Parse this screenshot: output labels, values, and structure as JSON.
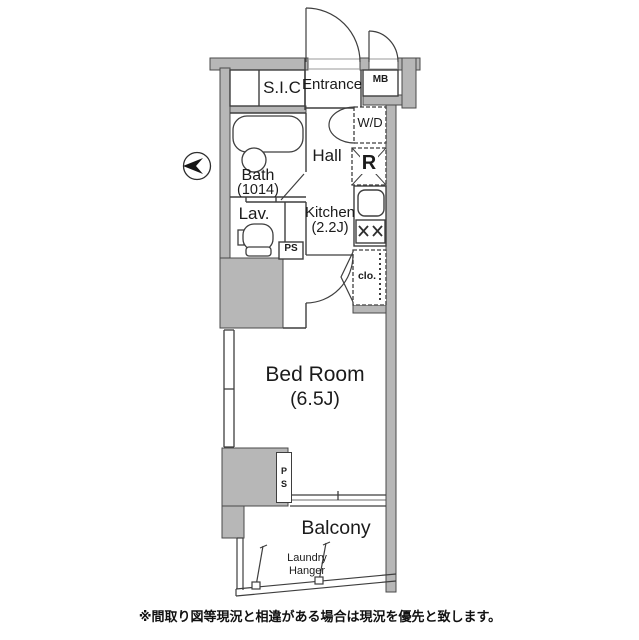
{
  "labels": {
    "sic": "S.I.C",
    "entrance": "Entrance",
    "mb": "MB",
    "wd": "W/D",
    "hall": "Hall",
    "refrigerator": "R",
    "bath": "Bath",
    "bath_size": "(1014)",
    "lav": "Lav.",
    "kitchen": "Kitchen",
    "kitchen_size": "(2.2J)",
    "ps_upper": "PS",
    "closet": "clo.",
    "bedroom": "Bed Room",
    "bedroom_size": "(6.5J)",
    "ps_lower_p": "P",
    "ps_lower_s": "S",
    "balcony": "Balcony",
    "laundry_line1": "Laundry",
    "laundry_line2": "Hanger"
  },
  "footnote": "※間取り図等現況と相違がある場合は現況を優先と致します。",
  "colors": {
    "background": "#ffffff",
    "wall_fill": "#b7b7b7",
    "line": "#3e3e3e",
    "text": "#1b1b1b"
  },
  "icons": [
    "north-arrow-icon",
    "bathtub-icon",
    "toilet-icon",
    "sink-icon",
    "stove-burners-icon",
    "refrigerator-cross-icon",
    "hanger-pipe-icon",
    "laundry-pole-icon",
    "door-swing-arc-icon",
    "sliding-window-icon"
  ]
}
